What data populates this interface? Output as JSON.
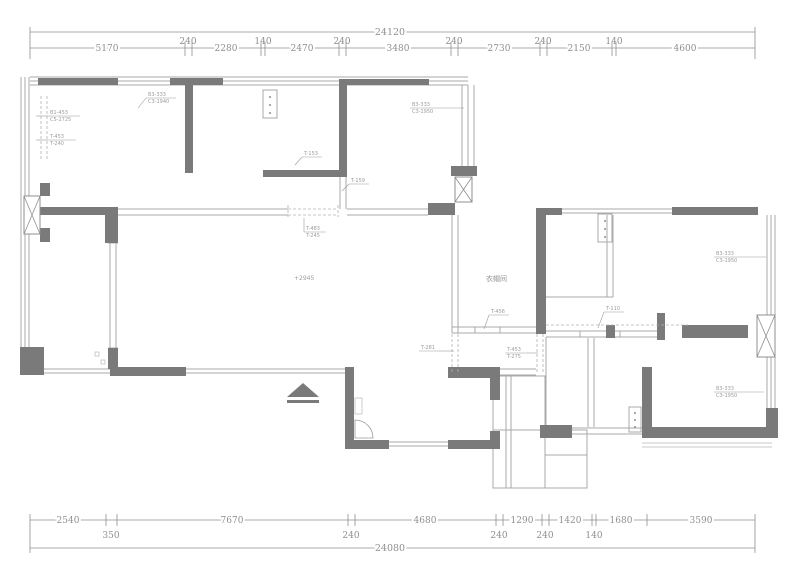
{
  "drawing": {
    "type": "architectural-floor-plan",
    "colors": {
      "wall": "#7a7a7a",
      "window_line": "#a9a9a9",
      "dimension": "#8f8f8f",
      "dashed": "#b2b2b2"
    },
    "dim_top": {
      "total": "24120",
      "segments": [
        "5170",
        "240",
        "2280",
        "140",
        "2470",
        "240",
        "3480",
        "240",
        "2730",
        "240",
        "2150",
        "140",
        "4600"
      ]
    },
    "dim_bottom": {
      "total": "24080",
      "row1": [
        "2540",
        "7670",
        "4680",
        "1290",
        "1420",
        "1680",
        "3590"
      ],
      "row2": [
        "350",
        "240",
        "240",
        "240",
        "140"
      ]
    },
    "labels": {
      "cloakroom": "衣帽间",
      "level": "+2945"
    },
    "annotations": {
      "a1a": "B1-453",
      "a1b": "C5-2725",
      "a2a": "T-453",
      "a2b": "T-240",
      "a3a": "B3-333",
      "a3b": "C3-1940",
      "a4a": "B3-333",
      "a4b": "C3-1950",
      "a5": "T-153",
      "a6": "T-159",
      "a7a": "T-483",
      "a7b": "T-245",
      "a10a": "B3-333",
      "a10b": "C3-1950",
      "a11": "T-110",
      "a12": "T-456",
      "a13": "T-281",
      "a14a": "T-453",
      "a14b": "T-275",
      "a15a": "B3-333",
      "a15b": "C3-1950"
    }
  }
}
